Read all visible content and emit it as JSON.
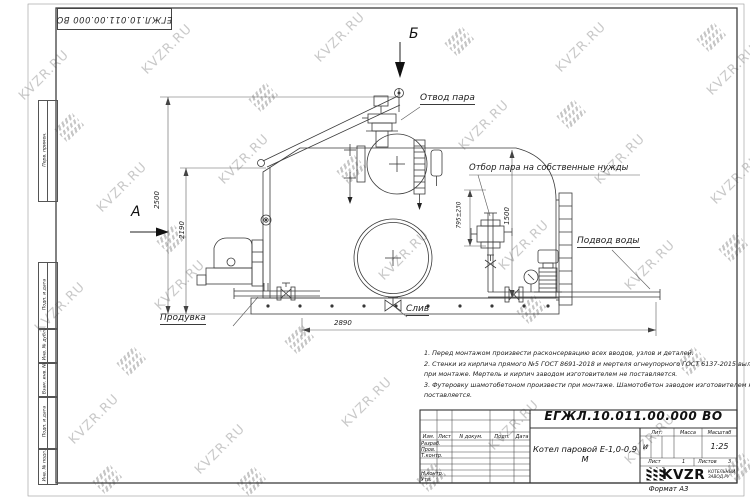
{
  "watermark": {
    "text": "KVZR.RU"
  },
  "frame": {
    "top_stamp": "ЕГЖЛ.10.011.00.000  ВО",
    "side_labels": [
      "Перв. примен.",
      "Подп. и дата",
      "Инв. № дубл.",
      "Взам. инв. №",
      "Подп. и дата",
      "Инв. № подл."
    ]
  },
  "drawing": {
    "labels": {
      "steam_out": "Отвод пара",
      "steam_own_needs": "Отбор пара на собственные нужды",
      "water_in": "Подвод воды",
      "blowdown": "Продувка",
      "drain": "Слив",
      "view_a": "А",
      "view_b": "Б"
    },
    "dimensions": {
      "height_total": "2500",
      "height_body": "2190",
      "drum_height": "1500",
      "nozzle_height": "795±230",
      "length": "2890"
    }
  },
  "notes": {
    "lines": [
      "1. Перед монтажом произвести расконсервацию всех вводов, узлов и деталей.",
      "2. Стенки из кирпича прямого №5 ГОСТ 8691-2018 и мертеля огнеупорного ГОСТ 6137-2015 выложить",
      "при монтаже. Мертель и кирпич заводом изготовителем не поставляется.",
      "3. Футеровку шамотобетоном произвести при монтаже. Шамотобетон заводом изготовителем не",
      "поставляется."
    ]
  },
  "title_block": {
    "doc_number": "ЕГЖЛ.10.011.00.000  ВО",
    "product_name": "Котел паровой Е-1,0-0,9 М",
    "header": {
      "izm": "Изм.",
      "list": "Лист",
      "n_dokum": "N докум.",
      "podp": "Подп.",
      "data": "Дата"
    },
    "rows": {
      "razrab": "Разраб.",
      "prov": "Пров.",
      "tkontr": "Т.контр.",
      "nkontr": "Н.контр.",
      "utv": "Утв."
    },
    "lit_label": "Лит.",
    "lit_value": "и",
    "massa_label": "Масса",
    "masshtab_label": "Масштаб",
    "scale": "1:25",
    "sheet_label": "Лист",
    "sheet_value": "1",
    "sheets_label": "Листов",
    "sheets_value": "3",
    "company": "KVZR",
    "company_sub1": "КОТЕЛЬНЫЙ",
    "company_sub2": "ЗАВОД.РУ",
    "format": "Формат А3"
  }
}
